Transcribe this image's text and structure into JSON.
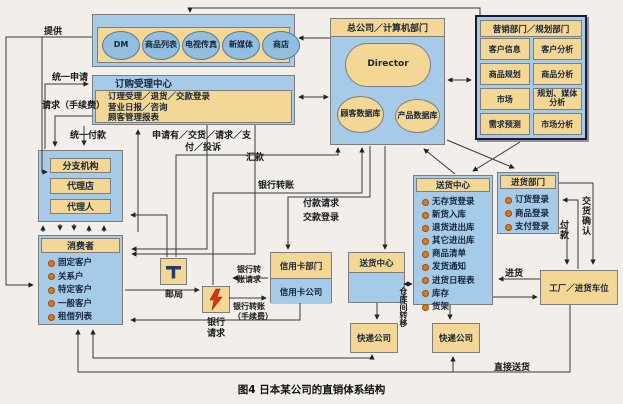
{
  "caption": "图4 日本某公司的直销体系结构",
  "media": {
    "channels": [
      "DM",
      "商品列表",
      "电视传真",
      "新媒体",
      "商店"
    ]
  },
  "order_center": {
    "title": "订购受理中心",
    "lines": [
      "订理受理／退货／交款登录",
      "营业日报／咨询",
      "顾客管理报表"
    ]
  },
  "hq": {
    "title": "总公司／计算机部门",
    "director": "Director",
    "db1": "顾客数据库",
    "db2": "产品数据库"
  },
  "marketing": {
    "title": "营销部门／规划部门",
    "items": [
      "客户信息",
      "客户分析",
      "商品规划",
      "商品分析",
      "市场",
      "规划、媒体分析",
      "需求预测",
      "市场分析"
    ]
  },
  "branch": {
    "items": [
      "分支机构",
      "代理店",
      "代理人"
    ]
  },
  "consumer": {
    "title": "消费者",
    "items": [
      "固定客户",
      "关系户",
      "特定客户",
      "一般客户",
      "租借列表"
    ]
  },
  "post_office": {
    "label": "邮局"
  },
  "bank": {
    "label": "银行"
  },
  "credit": {
    "dept": "信用卡部门",
    "company": "信用卡公司"
  },
  "delivery_small": {
    "title": "送货中心"
  },
  "delivery_big": {
    "title": "送货中心",
    "items": [
      "无存货登录",
      "新货入库",
      "退货进出库",
      "其它进出库",
      "商品清单",
      "发货通知",
      "进货日程表",
      "库存",
      "货架"
    ]
  },
  "purchasing": {
    "title": "进货部门",
    "items": [
      "订货登录",
      "商品登录",
      "支付登录"
    ]
  },
  "factory": {
    "label": "工厂／进货车位"
  },
  "express": {
    "label": "快递公司"
  },
  "labels": {
    "provide": "提供",
    "unified_apply": "统一申请",
    "request_fee": "请求（手续费）",
    "unified_pay": "统一付款",
    "apply_line1": "申请有／交货／请求／支",
    "apply_line2": "付／投诉",
    "remit": "汇款",
    "bank_transfer": "银行转账",
    "pay_request": "付款请求",
    "pay_register": "交款登录",
    "bt_req_1": "银行转",
    "bt_req_2": "账请求",
    "bt_fee_1": "银行转账",
    "bt_fee_2": "（手续费）",
    "request": "请求",
    "warehouse_transfer": "仓库间转移",
    "stock_in": "进货",
    "pay_v": "付款",
    "delivery_confirm": "交货确认",
    "direct_delivery": "直接送货"
  },
  "colors": {
    "blue": "#a6cbe9",
    "tan": "#f4d795",
    "bullet": "#e07818",
    "line": "#3a3a3a"
  }
}
